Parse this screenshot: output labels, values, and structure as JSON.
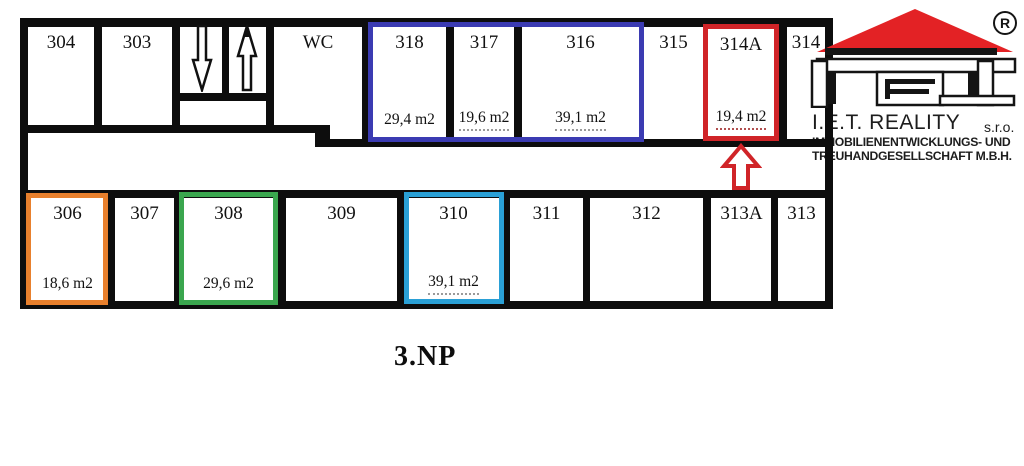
{
  "plan": {
    "floor_label": "3.NP",
    "top_row": [
      {
        "number": "304"
      },
      {
        "number": "303"
      },
      {
        "number": "WC"
      },
      {
        "number": "318",
        "area": "29,4 m2",
        "highlight": "blue"
      },
      {
        "number": "317",
        "area": "19,6 m2",
        "highlight": "blue"
      },
      {
        "number": "316",
        "area": "39,1 m2",
        "highlight": "blue"
      },
      {
        "number": "315"
      },
      {
        "number": "314A",
        "area": "19,4 m2",
        "highlight": "red"
      },
      {
        "number": "314"
      }
    ],
    "bottom_row": [
      {
        "number": "306",
        "area": "18,6 m2",
        "highlight": "orange"
      },
      {
        "number": "307"
      },
      {
        "number": "308",
        "area": "29,6 m2",
        "highlight": "green"
      },
      {
        "number": "309"
      },
      {
        "number": "310",
        "area": "39,1 m2",
        "highlight": "cyan"
      },
      {
        "number": "311"
      },
      {
        "number": "312"
      },
      {
        "number": "313A"
      },
      {
        "number": "313"
      }
    ],
    "highlight_colors": {
      "blue": "#3b3bb2",
      "red": "#d02428",
      "orange": "#e8802d",
      "green": "#3aa64e",
      "cyan": "#2aa0d6"
    },
    "pointer_arrow_color": "#d02428",
    "wall_color": "#0d0d0d"
  },
  "icons": {
    "stairs_down": "arrow-down-outline",
    "stairs_up": "arrow-up-outline",
    "unit_pointer": "arrow-up-red-outline"
  },
  "logo": {
    "registered": "®",
    "company": "I.E.T. REALITY",
    "suffix": "s.r.o.",
    "line2": "IMMOBILIENENTWICKLUNGS- UND",
    "line3": "TREUHANDGESELLSCHAFT M.B.H.",
    "roof_color": "#e32225"
  }
}
